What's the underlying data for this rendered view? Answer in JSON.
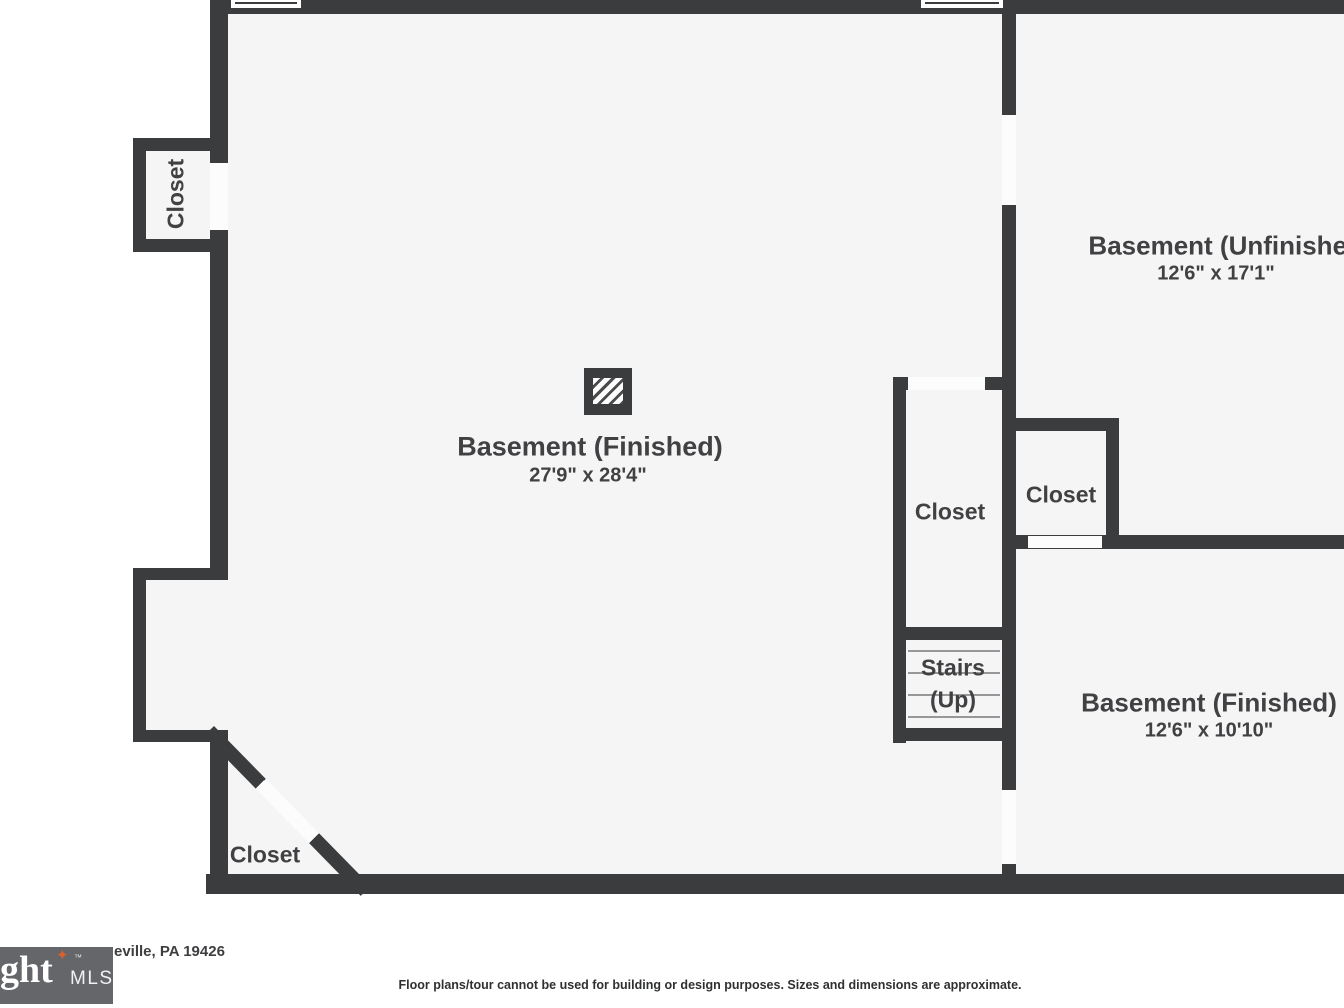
{
  "rooms": {
    "main": {
      "name": "Basement (Finished)",
      "dims": "27'9\" x 28'4\""
    },
    "top_right": {
      "name": "Basement (Unfinished)",
      "dims": "12'6\" x 17'1\""
    },
    "bottom_right": {
      "name": "Basement (Finished)",
      "dims": "12'6\" x 10'10\""
    },
    "closet_left": {
      "name": "Closet"
    },
    "closet_middle": {
      "name": "Closet"
    },
    "closet_right": {
      "name": "Closet"
    },
    "closet_bottom_left": {
      "name": "Closet"
    },
    "stairs": {
      "name": "Stairs",
      "direction": "(Up)"
    }
  },
  "footer": {
    "address_visible_fragment": "eville, PA 19426",
    "disclaimer": "Floor plans/tour cannot be used for building or design purposes. Sizes and dimensions are approximate.",
    "logo": {
      "visible_text": "ght",
      "trademark": "™",
      "suffix": "MLS",
      "star": "✦"
    }
  },
  "colors": {
    "wall": "#3b3c3e",
    "room_fill": "#f5f5f6",
    "door_gap": "#fcfcfd",
    "label_text": "#414143",
    "logo_background": "#64666a",
    "logo_star": "#d9622c"
  }
}
